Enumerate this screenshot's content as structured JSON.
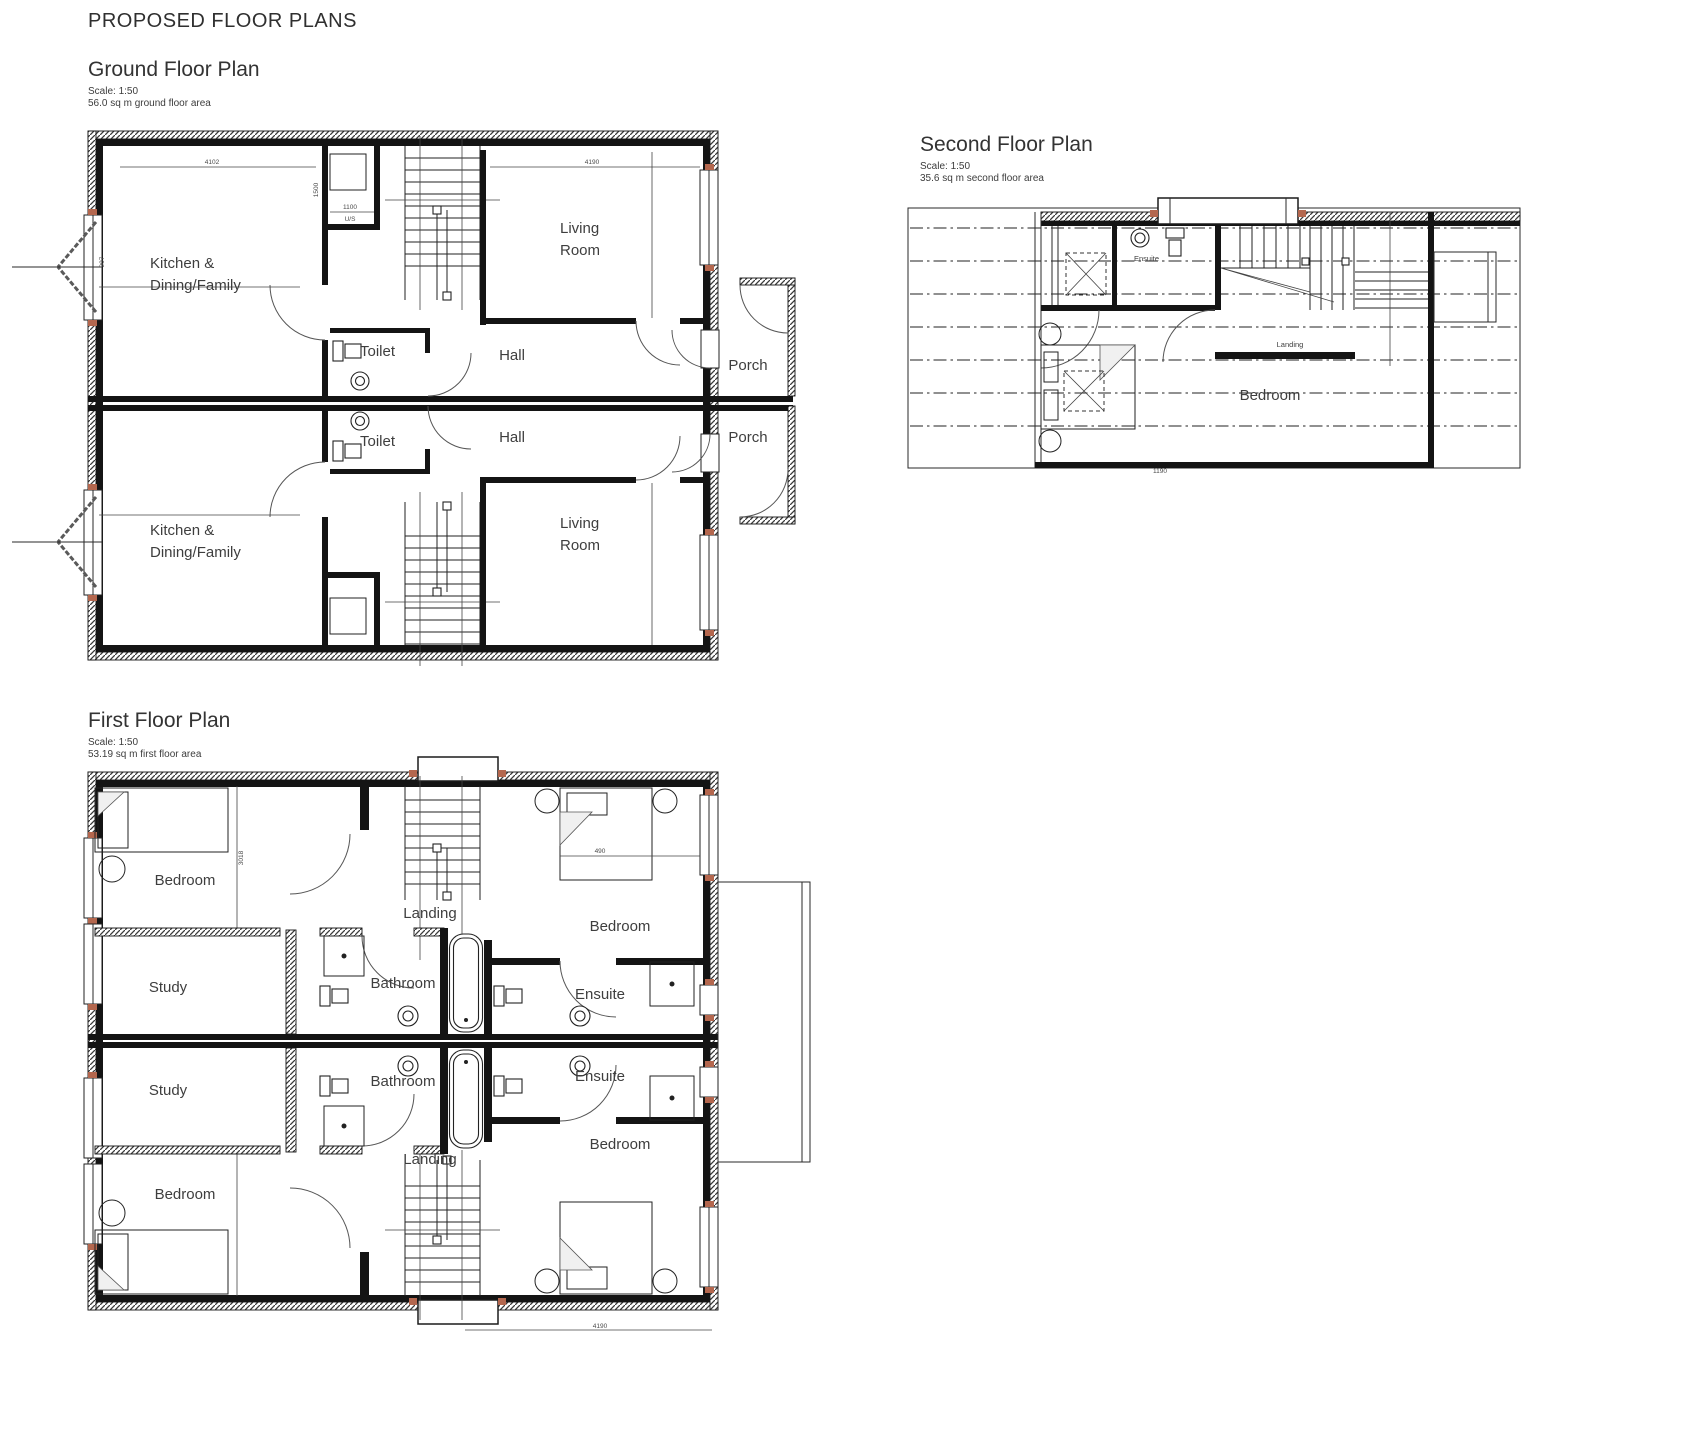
{
  "page": {
    "title": "PROPOSED FLOOR PLANS"
  },
  "plans": {
    "ground": {
      "title": "Ground Floor Plan",
      "scale": "Scale: 1:50",
      "area": "56.0 sq m ground floor area",
      "rooms": {
        "kitchen_top_line1": "Kitchen &",
        "kitchen_top_line2": "Dining/Family",
        "living_top_line1": "Living",
        "living_top_line2": "Room",
        "toilet_top": "Toilet",
        "hall_top": "Hall",
        "porch_top": "Porch",
        "kitchen_bottom_line1": "Kitchen &",
        "kitchen_bottom_line2": "Dining/Family",
        "living_bottom_line1": "Living",
        "living_bottom_line2": "Room",
        "toilet_bottom": "Toilet",
        "hall_bottom": "Hall",
        "porch_bottom": "Porch"
      },
      "dims": {
        "top_left": "4102",
        "top_right": "4190",
        "store_width": "1100",
        "store_note": "U/S",
        "left_wall": "907",
        "store_height": "1500"
      }
    },
    "first": {
      "title": "First Floor Plan",
      "scale": "Scale: 1:50",
      "area": "53.19 sq m first floor area",
      "rooms": {
        "bedroom_top_left": "Bedroom",
        "study_top": "Study",
        "landing_top": "Landing",
        "bathroom_top": "Bathroom",
        "ensuite_top": "Ensuite",
        "bedroom_top_right": "Bedroom",
        "study_bottom": "Study",
        "bedroom_bottom_left": "Bedroom",
        "landing_bottom": "Landing",
        "bathroom_bottom": "Bathroom",
        "ensuite_bottom": "Ensuite",
        "bedroom_bottom_right": "Bedroom"
      },
      "dims": {
        "bed_width": "490",
        "bottom": "4190",
        "bedroom_height": "3018"
      }
    },
    "second": {
      "title": "Second Floor Plan",
      "scale": "Scale: 1:50",
      "area": "35.6 sq m second floor area",
      "rooms": {
        "ensuite": "Ensuite",
        "landing": "Landing",
        "bedroom": "Bedroom"
      },
      "dims": {
        "bottom": "1190"
      }
    }
  }
}
